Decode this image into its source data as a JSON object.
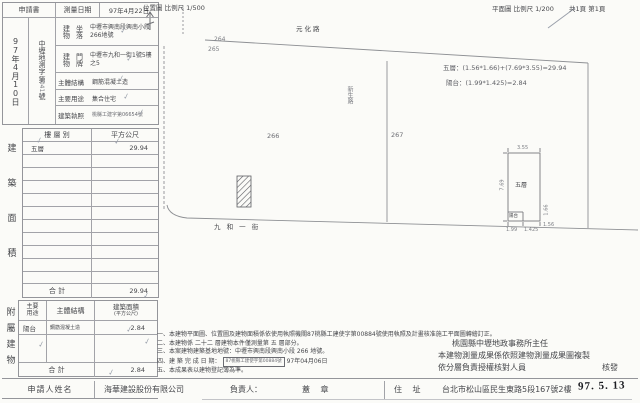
{
  "receipt": {
    "header": "申請書",
    "date": "97年4月10日",
    "office": "中壢地測字",
    "no_prefix": "第",
    "no_digits": "0415",
    "no_suffix": "號"
  },
  "survey": {
    "label": "測量日期",
    "value": "97年4月22日"
  },
  "form_rows": [
    {
      "label_a": "建物",
      "label_b": "坐落",
      "value": "中壢市興南段興南小段266地號"
    },
    {
      "label_a": "建物",
      "label_b": "門牌",
      "value": "中壢市九和一街1號5樓之5"
    },
    {
      "label": "主體結構",
      "value": "鋼筋混凝土造"
    },
    {
      "label": "主要用途",
      "value": "集合住宅"
    },
    {
      "label": "建築執照",
      "value": "桃縣工建字第06654號"
    }
  ],
  "area_table": {
    "side_label": "建築面積",
    "col_floor": "樓 層 別",
    "col_area": "平方公尺",
    "rows": [
      {
        "floor": "五層",
        "area": "29.94"
      }
    ],
    "total_label": "合  計",
    "total_value": "29.94"
  },
  "annex_table": {
    "side_label": "附屬建物",
    "col_use_a": "主要",
    "col_use_b": "用途",
    "col_structure": "主體結構",
    "col_area_1": "建築面積",
    "col_area_2": "(平方公尺)",
    "rows": [
      {
        "use": "陽台",
        "structure": "鋼筋混凝土造",
        "area": "2.84"
      }
    ],
    "total_label": "合  計",
    "total_value": "2.84"
  },
  "applicant_row": {
    "label": "申請人姓名",
    "name": "海華建設股份有限公司",
    "manager_label": "負責人：",
    "seal_label": "蓋  章",
    "address_label": "住  址",
    "address": "台北市松山區民生東路5段167號2樓"
  },
  "site_plan": {
    "title": "位置圖 比例尺 1/500",
    "road_top": "元化路",
    "road_bottom": "九 和 一 街",
    "road_side": "新生路",
    "lot_264": "264",
    "lot_265": "265",
    "lot_266": "266",
    "lot_267": "267"
  },
  "floor_plan": {
    "title": "平面圖 比例尺 1/200",
    "pages": "共1頁  第1頁",
    "calc_line_1": "五層：(1.56*1.66)+(7.69*3.55)=29.94",
    "calc_line_2": "陽台：(1.99*1.425)=2.84",
    "room_label": "五層",
    "balcony_label": "陽台",
    "dim_top": "3.55",
    "dim_left": "7.69",
    "dim_balcony_w": "1.99",
    "dim_balcony_d": "1.425",
    "dim_ext_w": "1.56",
    "dim_ext_h": "1.66"
  },
  "notes": {
    "line_1": "一、本建物平面圖、位置圖及建物面積係依使用執照機關87桃縣工建使字第00884號使用執照及計畫核准施工平面圖轉繪訂正。",
    "line_2": "二、本建物係 二十二 層建物本件僅測量第 五 層部分。",
    "line_3": "三、本案建物建築基地地號：中壢市興南段興南小段 266 地號。",
    "line_4_prefix": "四、建 築 完 成 日 期：",
    "line_4_date": "97年04月06日",
    "line_5": "五、本成果表以建物登記簿為準。"
  },
  "officials": {
    "line_1": "桃園縣中壢地政事務所主任",
    "line_2": "本建物測量成果係依照建物測量成果圖複製",
    "line_3": "依分層負責授權核對人員",
    "line_3_right": "核發"
  },
  "stamps": {
    "received_date": "97. 5. 13",
    "license_box": "87桃縣工建使字第00884號"
  },
  "icons": {
    "check": "✓"
  }
}
